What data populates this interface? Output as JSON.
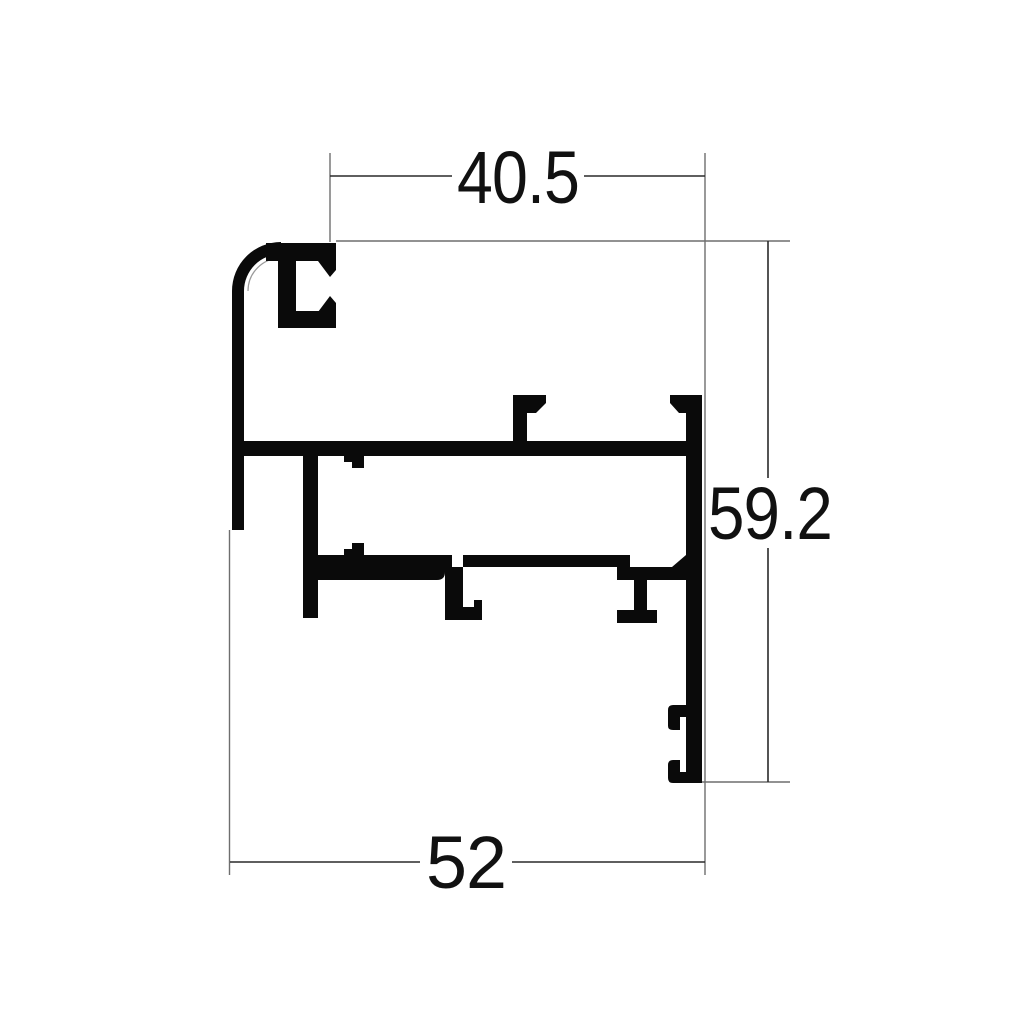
{
  "drawing": {
    "kind": "extrusion-profile-cross-section",
    "dimensions": {
      "top_width": "40.5",
      "side_height": "59.2",
      "bottom_width": "52"
    },
    "colors": {
      "profile": "#0a0a0a",
      "dimension_line": "#2a2a2a",
      "extension_line": "#6e6e6e",
      "tangent_line": "#9a9a9a",
      "label": "#111111",
      "background": "#ffffff"
    }
  }
}
